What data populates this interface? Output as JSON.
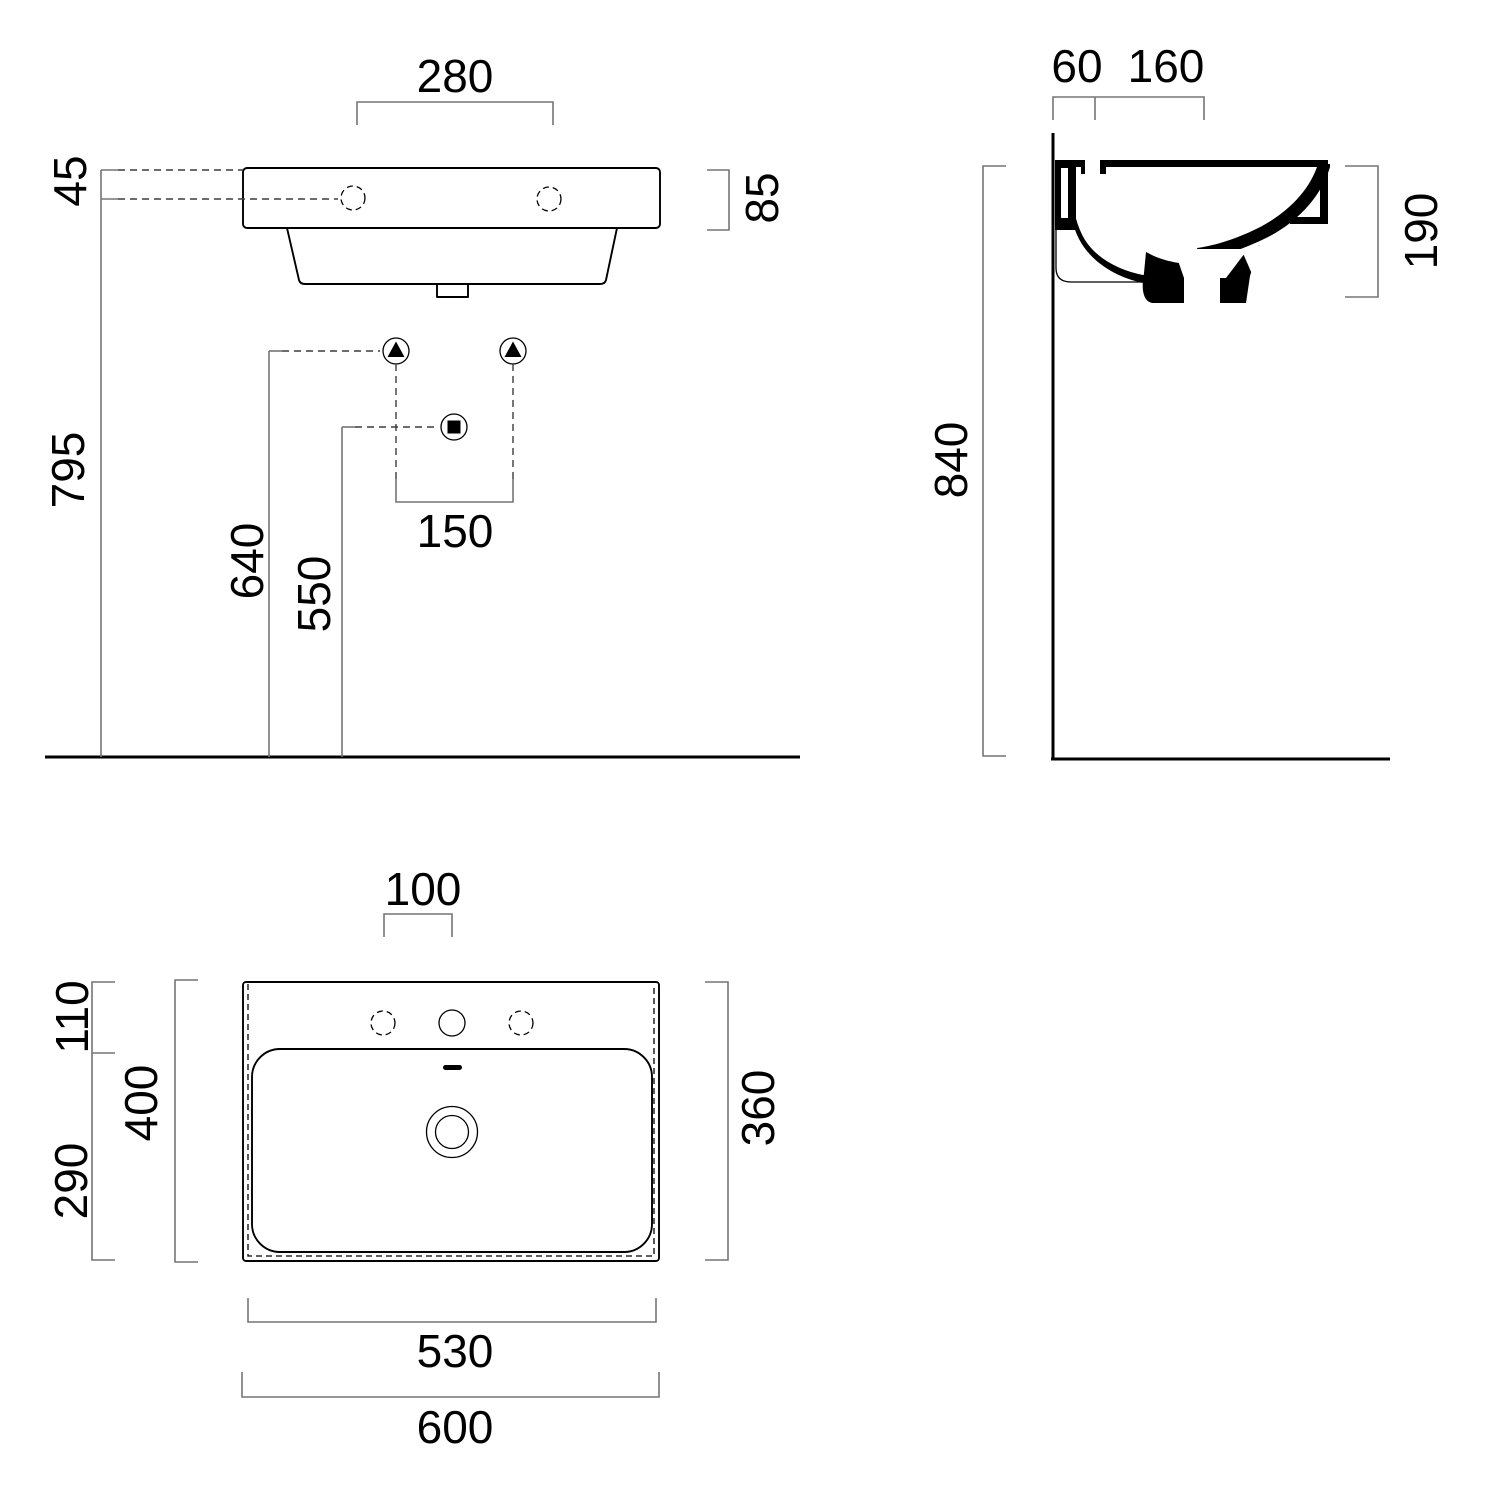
{
  "drawing_type": "washbasin technical dimension drawing (front elevation, side section, plan view)",
  "colors": {
    "object_line": "#000000",
    "dimension_line": "#757575",
    "leader_line": "#3c3c3c",
    "background": "#ffffff"
  },
  "symbols": {
    "water_supply": "triangle-in-circle",
    "waste_outlet": "square-in-circle"
  },
  "front_view": {
    "dims": {
      "tap_hole_spacing": "280",
      "rim_to_tapholes": "45",
      "apron_height": "85",
      "rim_height_from_floor": "795",
      "water_supply_height": "640",
      "waste_outlet_height": "550",
      "supply_spacing": "150"
    }
  },
  "section_view": {
    "dims": {
      "wall_to_taphole": "60",
      "taphole_to_overflow": "160",
      "basin_depth": "190",
      "rim_height_from_floor": "840"
    }
  },
  "plan_view": {
    "dims": {
      "taphole_offset": "100",
      "deck_depth": "110",
      "inner_bowl_depth": "400",
      "front_depth": "290",
      "side_depth": "360",
      "bowl_width": "530",
      "overall_width": "600"
    }
  }
}
